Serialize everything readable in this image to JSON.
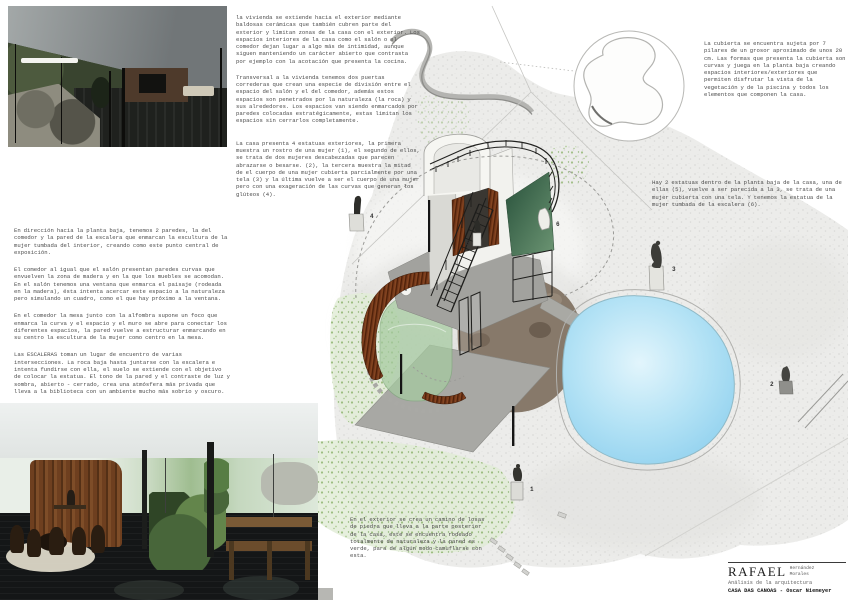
{
  "poster": {
    "credits": {
      "name_large": "RAFAEL",
      "name_small_line1": "Hernández",
      "name_small_line2": "Morales",
      "subtitle": "Análisis de la arquitectura",
      "project": "CASA DAS CANOAS - Oscar Niemeyer"
    },
    "text_blocks": {
      "envelope": {
        "p1": "la vivienda se extiende hacia el exterior mediante baldosas cerámicas que también cubren parte del exterior y limitan zonas de la casa con el exterior. Los espacios interiores de la casa como el salón o el comedor dejan lugar a algo más de intimidad, aunque siguen manteniendo un carácter abierto que contrasta por ejemplo con la acotación que presenta la cocina.",
        "p2": "Transversal a la vivienda tenemos dos puertas correderas que crean una especie de división entre el espacio del salón y el del comedor, además estos espacios son penetrados por la naturaleza (la roca) y sus alrededores. Los espacios van siendo enmarcados por paredes colocadas estratégicamente, estas limitan los espacios sin cerrarlos completamente."
      },
      "exterior_statues": {
        "p1": "La casa presenta 4 estatuas exteriores, la primera muestra un rostro de una mujer (1), el segundo de ellos, se trata de dos mujeres descabezadas que parecen abrazarse o besarse. (2), la tercera muestra la mitad de el cuerpo de una mujer cubierta parcialmente por una tela (3) y la última vuelve a ser el cuerpo de una mujer pero con una exageración de las curvas que generan los glúteos (4)."
      },
      "interior_analysis": {
        "p1": "En dirección hacia la planta baja, tenemos 2 paredes, la del comedor y la pared de la escalera que enmarcan la escultura de la mujer tumbada del interior, creando como este punto central de exposición.",
        "p2": "El comedor al igual que el salón presentan paredes curvas que envuelven la zona de madera y en la que los muebles se acomodan. En el salón tenemos una ventana que enmarca el paisaje (rodeada en la madera), ésta intenta acercar este espacio a la naturaleza pero simulando un cuadro, como el que hay próximo a la ventana.",
        "p3": "En el comedor la mesa junto con la alfombra supone un foco que enmarca la curva y el espacio y el muro se abre para conectar los diferentes espacios, la pared vuelve a estructurar enmarcando en su centro la escultura de la mujer como centro en la mesa.",
        "p4": "Las ESCALERAS toman un lugar de encuentro de varias intersecciones. La roca baja hasta juntarse con la escalera e intenta fundirse con ella, el suelo se extiende con el objetivo de colocar la estatua. El tono de la pared y el contraste de luz y sombra, abierto - cerrado, crea una atmósfera más privada que lleva a la biblioteca con un ambiente mucho más sobrio y oscuro."
      },
      "roof": {
        "p1": "La cubierta se encuentra sujeta por 7 pilares de un grosor aproximado de unos 20 cm. Las formas que presenta la cubierta son curvas y juega en la planta baja creando espacios interiores/exteriores que permiten disfrutar la vista de la vegetación y de la piscina y todos los elementos que componen la casa."
      },
      "interior_statues": {
        "p1": "Hay 2 estatuas dentro de la planta baja de la casa, una de ellas (5), vuelve a ser parecida a la 3, se trata de una mujer cubierta con una tela. Y tenemos la estatua de la mujer tumbada de la escalera (6)."
      },
      "exterior_path": {
        "p1": "En el exterior se crea un camino de losas de piedra que lleva a la parte posterior de la casa, este se encuentra rodeado totalmente de naturaleza y la pared es verde, para de algún modo camuflarse con esta."
      }
    },
    "drawing": {
      "markers": [
        {
          "n": "1"
        },
        {
          "n": "2"
        },
        {
          "n": "3"
        },
        {
          "n": "4"
        },
        {
          "n": "5"
        },
        {
          "n": "6"
        }
      ],
      "colors": {
        "pool": "#a9ddf3",
        "grass": "#9fbf8a",
        "green_wall": "#3f6b4f",
        "wood": "#74381b",
        "soil": "#87796a",
        "terrain": "#ececea"
      }
    }
  }
}
